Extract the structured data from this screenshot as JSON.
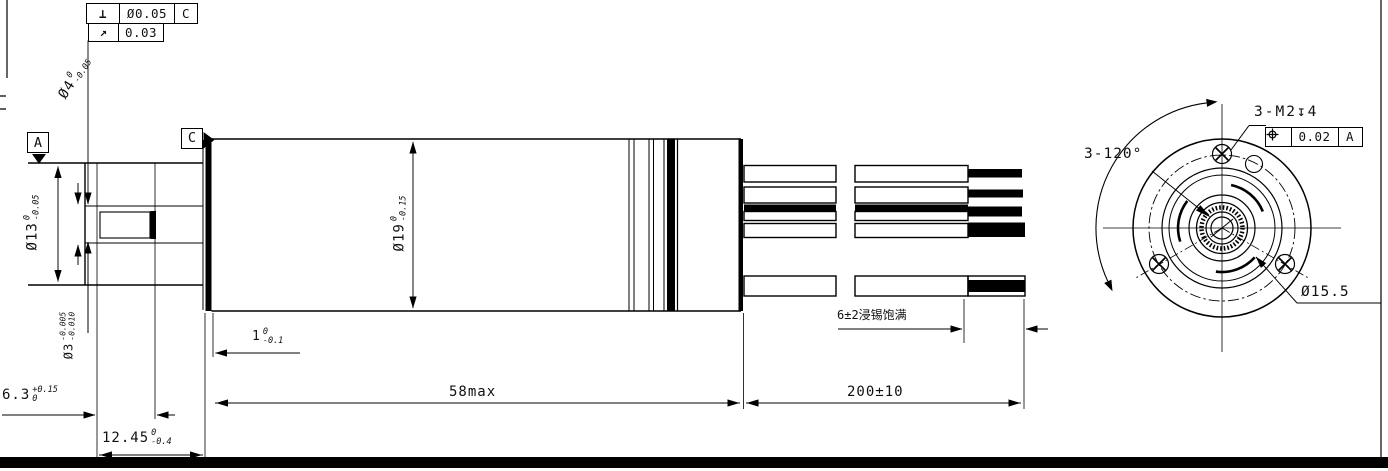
{
  "tolerance_frames": {
    "perpendicularity": {
      "symbol": "⊥",
      "value": "Ø0.05",
      "datum": "C"
    },
    "runout": {
      "symbol": "↗",
      "value": "0.03"
    },
    "position": {
      "value": "0.02",
      "datum": "A"
    }
  },
  "datums": {
    "a": "A",
    "c": "C"
  },
  "dimensions": {
    "shaft_dia": {
      "text": "Ø4",
      "tol_top": "0",
      "tol_bot": "-0.05"
    },
    "front_dia": {
      "text": "Ø13",
      "tol_top": "0",
      "tol_bot": "-0.05"
    },
    "pinion_dia": {
      "text": "Ø3",
      "tol_top": "-0.005",
      "tol_bot": "-0.010"
    },
    "body_dia": {
      "text": "Ø19",
      "tol_top": "0",
      "tol_bot": "-0.15"
    },
    "shoulder_len": {
      "text": "6.3",
      "tol_top": "+0.15",
      "tol_bot": "0"
    },
    "shaft_len": {
      "text": "12.45",
      "tol_top": "0",
      "tol_bot": "-0.4"
    },
    "lip_len": {
      "text": "1",
      "tol_top": "0",
      "tol_bot": "-0.1"
    },
    "body_len": {
      "text": "58max"
    },
    "lead_len": {
      "text": "200±10"
    },
    "tinned_len": {
      "text": "6±2浸锡饱满"
    },
    "bolt_circle_dia": {
      "text": "Ø15.5"
    },
    "tapped_holes": {
      "text": "3-M2↧4"
    },
    "hole_angle": {
      "text": "3-120°"
    }
  }
}
